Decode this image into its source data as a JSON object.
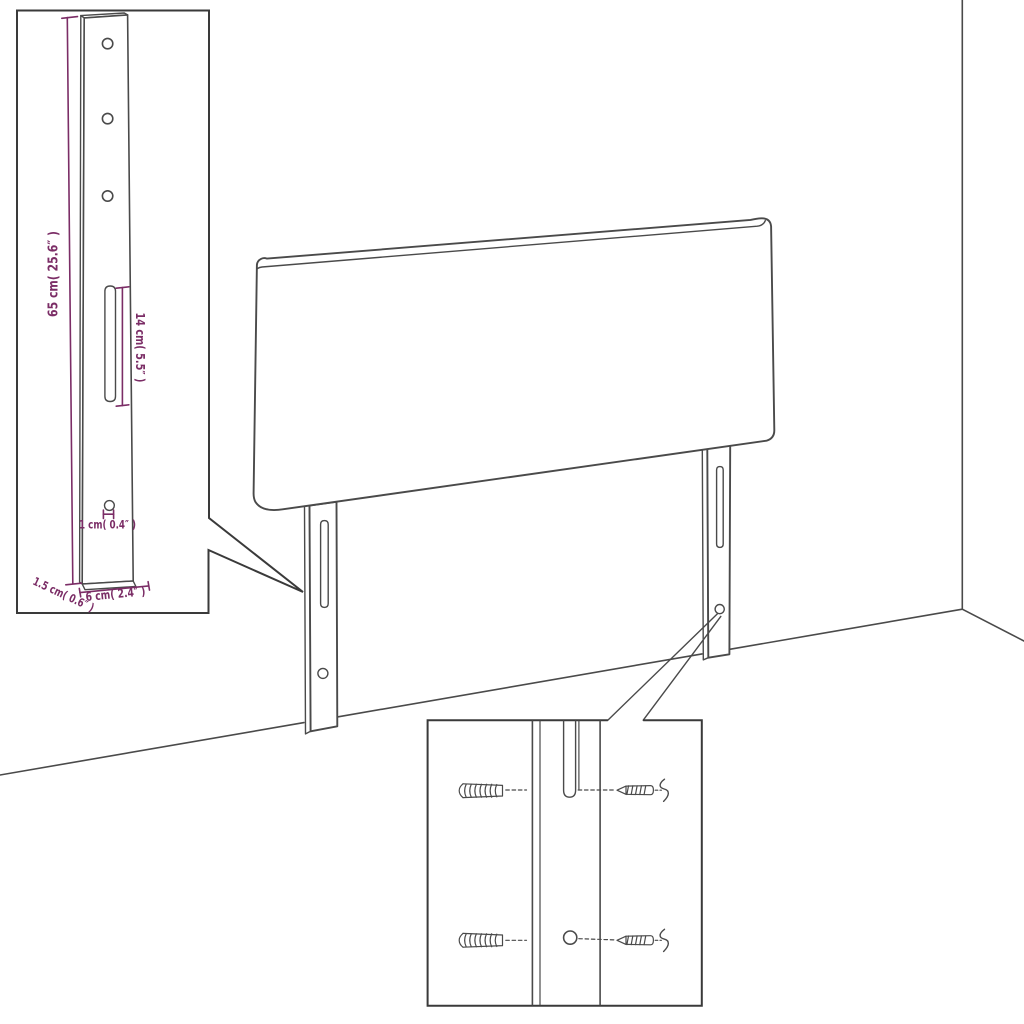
{
  "diagram": {
    "subject": "headboard-with-legs-assembly-diagram"
  },
  "dimensions": {
    "leg_height": "65 cm( 25.6″ )",
    "slot_length": "14 cm( 5.5″ )",
    "hole_diameter": "1 cm( 0.4″ )",
    "leg_thickness": "1.5 cm( 0.6″ )",
    "leg_width": "6 cm( 2.4″ )"
  },
  "colors": {
    "background": "#ffffff",
    "line": "#4a4a4a",
    "inset_border": "#3a3a3a",
    "dimension": "#7b2d66"
  }
}
